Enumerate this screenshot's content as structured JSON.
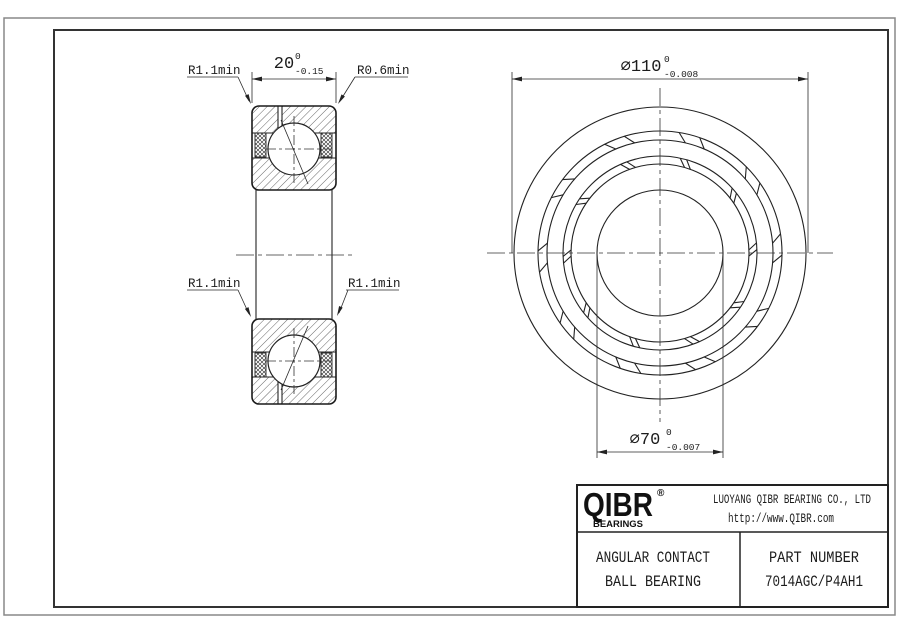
{
  "drawing": {
    "section_view": {
      "leader_labels": {
        "top_left": "R1.1min",
        "top_right": "R0.6min",
        "mid_left": "R1.1min",
        "mid_right": "R1.1min"
      },
      "width_dim": {
        "value": "20",
        "tol_upper": "0",
        "tol_lower": "-0.15"
      }
    },
    "front_view": {
      "od_dim": {
        "value": "⌀110",
        "tol_upper": "0",
        "tol_lower": "-0.008"
      },
      "bore_dim": {
        "value": "⌀70",
        "tol_upper": "0",
        "tol_lower": "-0.007"
      }
    }
  },
  "title_block": {
    "logo_text": "QIBR",
    "logo_registered": "®",
    "logo_subtext": "BEARINGS",
    "company_name": "LUOYANG QIBR BEARING CO., LTD",
    "website": "http://www.QIBR.com",
    "product_type_line1": "ANGULAR CONTACT",
    "product_type_line2": "BALL BEARING",
    "part_number_label": "PART NUMBER",
    "part_number": "7014AGC/P4AH1"
  },
  "colors": {
    "line": "#222222",
    "frame_outer": "#888888",
    "background": "#ffffff"
  }
}
